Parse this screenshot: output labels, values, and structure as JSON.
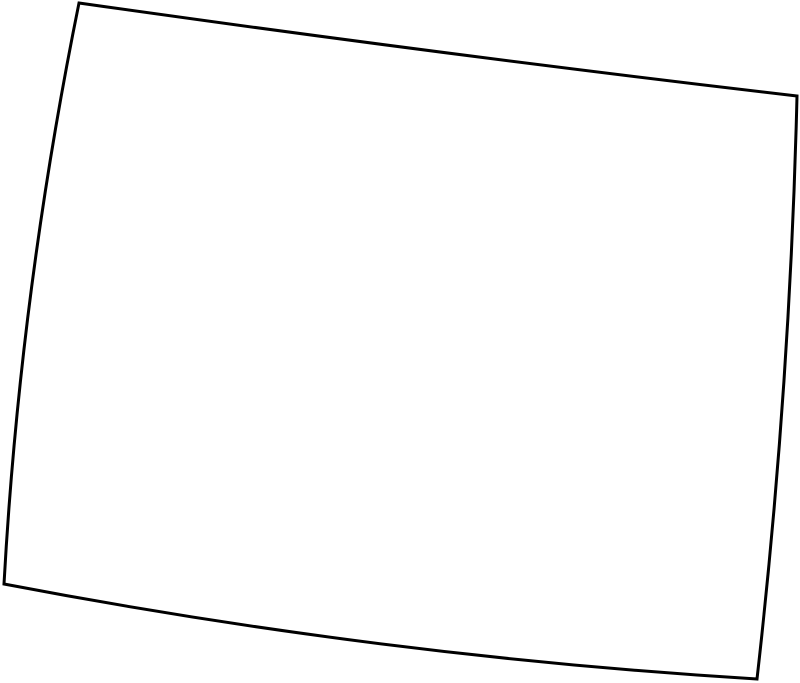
{
  "canvas": {
    "width": 800,
    "height": 683,
    "background_color": "#ffffff"
  },
  "outline": {
    "shape_name": "state-outline",
    "shape_type": "closed quadrilateral with slightly curved edges",
    "stroke_color": "#000000",
    "fill_color": "none",
    "stroke_width": 3,
    "corners": {
      "north_west": [
        79,
        3
      ],
      "north_east": [
        797,
        96
      ],
      "south_east": [
        757,
        679
      ],
      "south_west": [
        4,
        584
      ]
    },
    "edge_curvature_px": {
      "top_sag_down": 2,
      "right_bow_right": 7,
      "bottom_sag_down": 12,
      "left_bow_left": 10
    },
    "path": "M 79 3 Q 438 54 797 96 Q 790 388 757 679 Q 380 656 4 584 Q 20 294 79 3 Z"
  }
}
